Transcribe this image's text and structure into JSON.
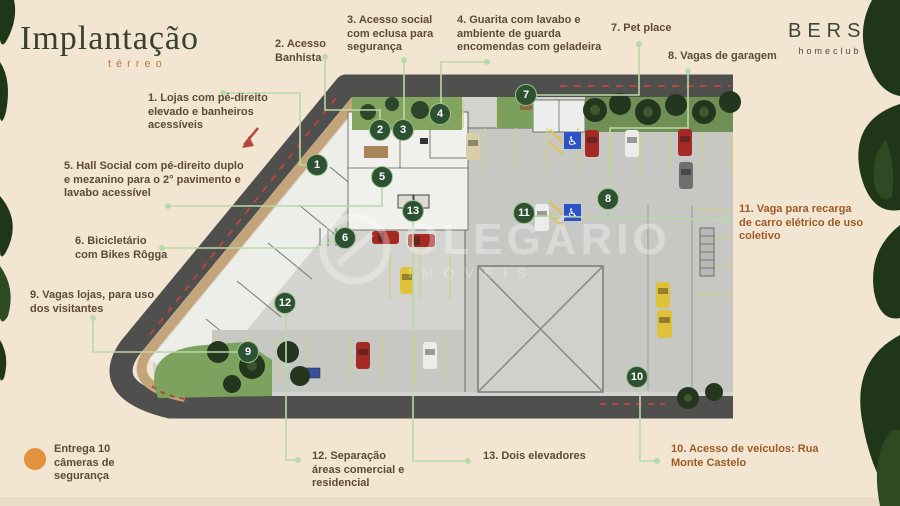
{
  "header": {
    "title": "Implantação",
    "subtitle": "térreo"
  },
  "brand": {
    "name": "BERSI",
    "tagline": "homeclub"
  },
  "watermark": {
    "line1": "OLEGÁRIO",
    "line2": "IMÓVEIS"
  },
  "note": {
    "text": "Entrega 10 câmeras de segurança"
  },
  "annotations": [
    {
      "num": "1",
      "label": "1. Lojas com pé-direito elevado e banheiros acessíveis"
    },
    {
      "num": "2",
      "label": "2. Acesso Banhista"
    },
    {
      "num": "3",
      "label": "3. Acesso social com eclusa para segurança"
    },
    {
      "num": "4",
      "label": "4. Guarita com lavabo e ambiente de guarda encomendas com geladeira"
    },
    {
      "num": "5",
      "label": "5. Hall Social com pé-direito duplo e mezanino para o 2° pavimento e lavabo acessível"
    },
    {
      "num": "6",
      "label": "6. Bicicletário com Bikes Rôgga"
    },
    {
      "num": "7",
      "label": "7. Pet place"
    },
    {
      "num": "8",
      "label": "8. Vagas de garagem"
    },
    {
      "num": "9",
      "label": "9. Vagas lojas, para uso dos visitantes"
    },
    {
      "num": "10",
      "label": "10. Acesso de veículos: Rua Monte Castelo"
    },
    {
      "num": "11",
      "label": "11. Vaga para recarga de carro elétrico de uso coletivo"
    },
    {
      "num": "12",
      "label": "12. Separação áreas comercial e residencial"
    },
    {
      "num": "13",
      "label": "13. Dois elevadores"
    }
  ],
  "colors": {
    "background": "#f2e6d2",
    "marker_green": "#2d5233",
    "marker_border": "#9cc284",
    "leader_green": "#b9daa6",
    "label_brown": "#5d4a37",
    "label_orange": "#9e5a27",
    "note_orange": "#e2913d",
    "title_green": "#39402f",
    "road_gray": "#4f4f4d",
    "sidewalk_tan": "#c4a47b"
  }
}
